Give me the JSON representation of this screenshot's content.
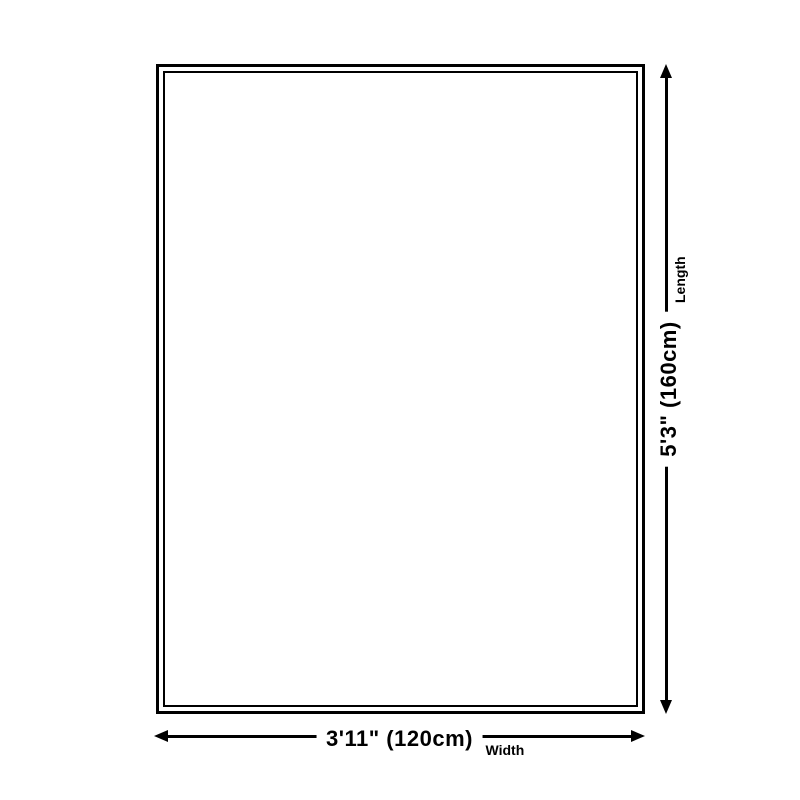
{
  "diagram": {
    "kind": "rug-size-dimension-diagram",
    "dimensions": {
      "width": {
        "value": "3'11\" (120cm)",
        "label": "Width"
      },
      "length": {
        "value": "5'3\" (160cm)",
        "label": "Length"
      }
    },
    "icons": {
      "horizontal_arrow": "double-headed-arrow-left-right",
      "vertical_arrow": "double-headed-arrow-up-down"
    }
  },
  "colors": {
    "line": "#000000",
    "background": "#ffffff"
  }
}
